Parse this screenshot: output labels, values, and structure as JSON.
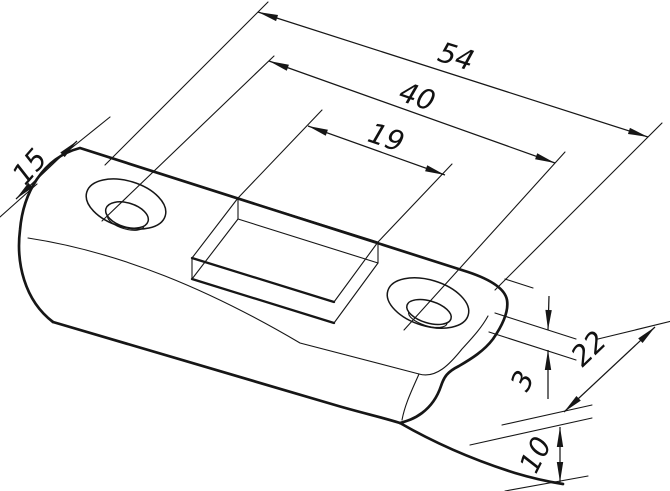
{
  "drawing": {
    "type": "isometric-technical-drawing",
    "part": "strike-plate-with-countersunk-holes-rectangular-cutout-and-bent-lip",
    "units_shown": "none (numeric values only)",
    "line_color": "#161616",
    "background": "#ffffff"
  },
  "dimensions": {
    "overall_length": "54",
    "hole_spacing": "40",
    "cutout_length": "19",
    "hole_edge_offset": "15",
    "lip_offset": "3",
    "overall_width": "22",
    "lip_height": "10"
  }
}
